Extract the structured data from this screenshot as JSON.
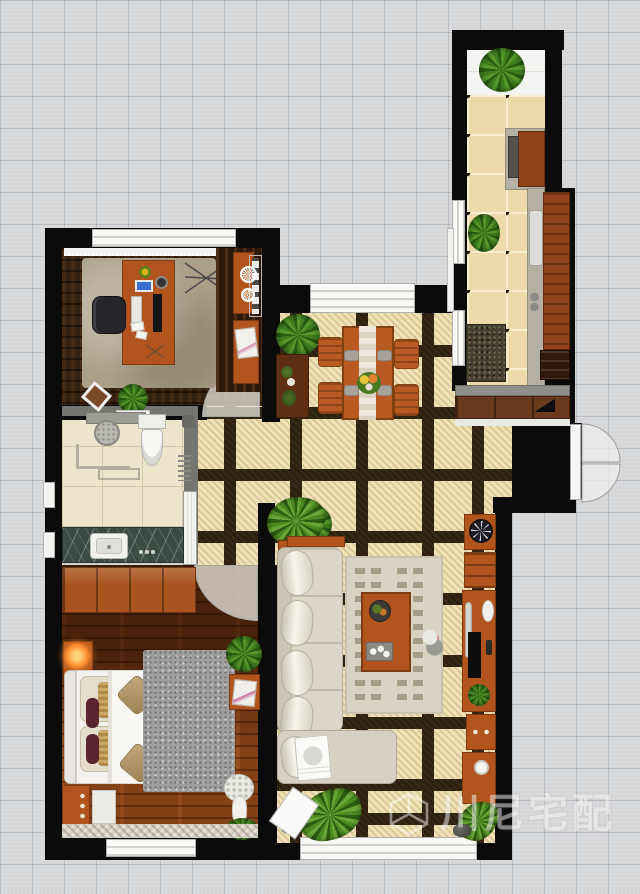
{
  "watermark": {
    "text": "川尼宅配",
    "logo": "cube-logo"
  },
  "palette": {
    "background": "#d4d6d8",
    "grid_line": "#c7cacc",
    "wall": "#0b0b0b",
    "partition_wall": "#75756f",
    "hall_tile": "#f1e2b6",
    "hall_grout": "#2c2110",
    "kitchen_tile": "#eddaa8",
    "bath_tile": "#ece4cb",
    "dark_wood_floor": "#33200f",
    "orange_wood_floor": "#7c3c14",
    "furniture_orange": "#b2541d",
    "sofa_beige": "#dbd6c8",
    "living_rug": "#d9d3c4",
    "study_rug": "#ab9f87",
    "bedroom_rug": "#9e9e9e",
    "marble_counter": "#3c4a44",
    "window_white": "#f8f8f6",
    "plant_green": "#3f7d1f",
    "lamp_glow": "#ff9030"
  },
  "rooms": [
    {
      "id": "balcony"
    },
    {
      "id": "kitchen"
    },
    {
      "id": "study"
    },
    {
      "id": "bathroom"
    },
    {
      "id": "master-bedroom"
    },
    {
      "id": "dining-area"
    },
    {
      "id": "living-room"
    },
    {
      "id": "entry-hall"
    }
  ],
  "furniture": {
    "balcony": [
      "potted-palm"
    ],
    "kitchen": [
      "stove-counter",
      "cooktop",
      "sink-counter",
      "sink",
      "wood-counter",
      "dark-cabinet",
      "potted-plant",
      "doormat"
    ],
    "entry_hall": [
      "shoe-cabinet",
      "entry-double-door",
      "fern",
      "console-table",
      "potted-plant"
    ],
    "study": [
      "window",
      "curtain",
      "rug",
      "desk",
      "office-chair",
      "monitor",
      "keyboard",
      "tablet",
      "desk-lamp",
      "desk-flower",
      "papers",
      "drying-rack-symbol",
      "bookshelf",
      "side-cabinet",
      "side-desk",
      "magazine",
      "lace-doilies",
      "picture-frame",
      "potted-plant",
      "door-arc"
    ],
    "bathroom": [
      "shower-shelf",
      "shower-head",
      "toilet",
      "wall-fixture",
      "towel-rack",
      "glass-partition",
      "vanity-counter",
      "sink",
      "sliding-door"
    ],
    "master_bedroom": [
      "wardrobe",
      "nightstand",
      "lamp",
      "double-bed",
      "headboard",
      "pillows",
      "duvet",
      "throw-pillows",
      "book",
      "rug",
      "potted-plant",
      "side-table",
      "magazine",
      "bench",
      "dresser",
      "hydrangea",
      "vase",
      "potted-plant-2",
      "carpet-runner",
      "window",
      "door-arc"
    ],
    "dining_area": [
      "window",
      "dining-table",
      "table-runner",
      "dining-chair-1",
      "dining-chair-2",
      "dining-chair-3",
      "dining-chair-4",
      "place-settings",
      "flower-centerpiece"
    ],
    "living_room": [
      "sofa",
      "sofa-pillows",
      "chaise",
      "sofa-back-table",
      "potted-plant",
      "rug",
      "coffee-table",
      "fruit-plate",
      "serving-tray",
      "figurine",
      "clock-medallion",
      "upper-cabinet",
      "tv-cabinet",
      "soundbar",
      "tv",
      "oval-dish",
      "cabinet-plant",
      "lower-cabinet",
      "side-desk",
      "bowl",
      "fern-left",
      "fern-right",
      "rocks",
      "tilted-card",
      "book",
      "window"
    ]
  }
}
